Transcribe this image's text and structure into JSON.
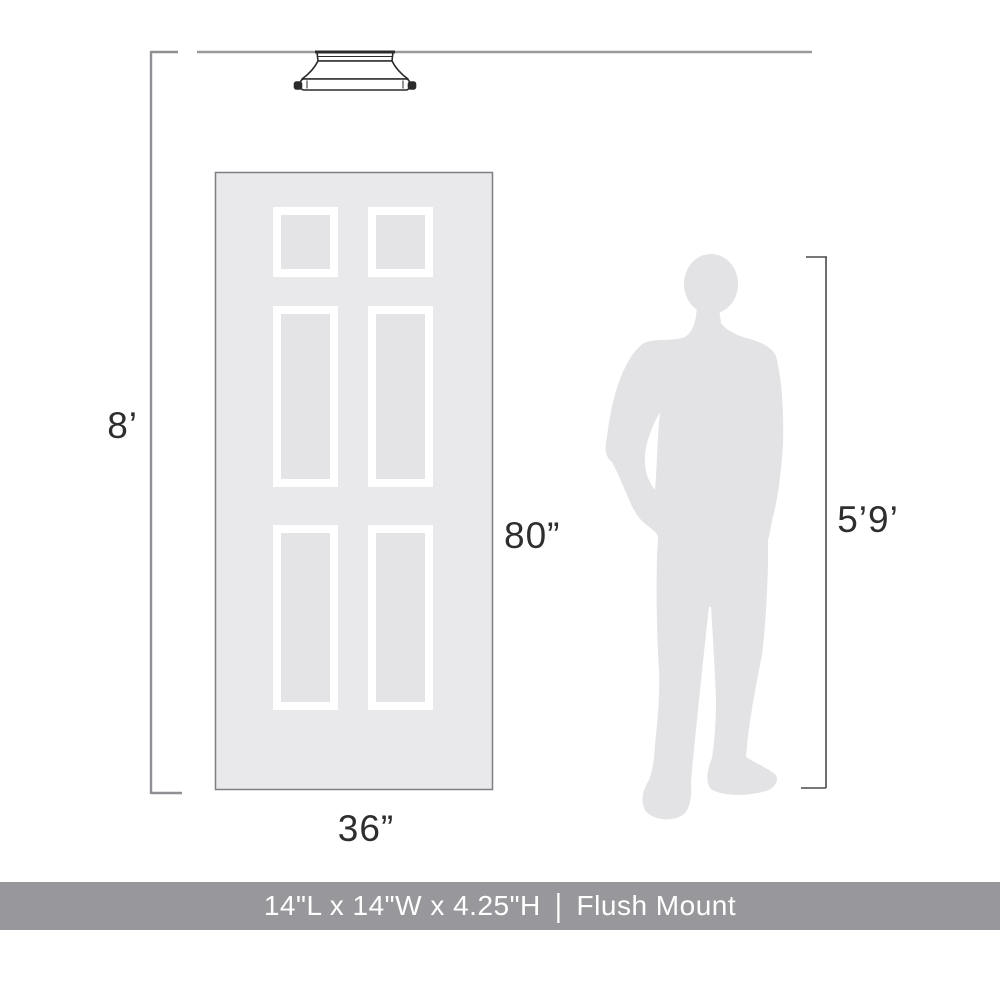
{
  "diagram": {
    "ceiling": {
      "height_label": "8’"
    },
    "door": {
      "height_label": "80”",
      "width_label": "36”"
    },
    "person": {
      "height_label": "5’9’"
    },
    "fixture": {
      "name": "flush-mount-ceiling-light"
    },
    "colors": {
      "door_fill": "#e9e9eb",
      "door_border": "#7f7f83",
      "panel_frame": "#ffffff",
      "panel_fill": "#e4e4e7",
      "person_fill": "#e3e3e6",
      "bracket_line": "#909094",
      "person_bracket_line": "#4a4a4e",
      "fixture_stroke": "#2b2b2b",
      "fixture_fill": "#ffffff",
      "label_text": "#2e2e30",
      "footer_bg": "#98989c",
      "footer_text": "#ffffff"
    }
  },
  "footer": {
    "dimensions": "14\"L x 14\"W x 4.25\"H",
    "separator": "|",
    "product_type": "Flush Mount"
  }
}
